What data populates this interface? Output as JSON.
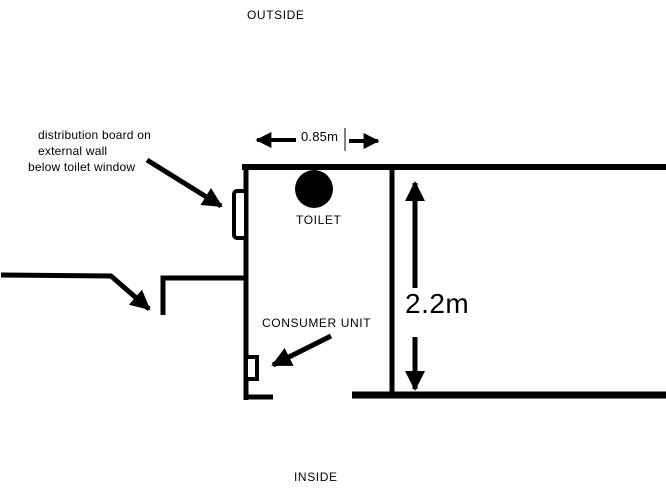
{
  "window": {
    "background": "#ffffff",
    "ink": "#000000"
  },
  "labels": {
    "outside": "OUTSIDE",
    "inside": "INSIDE",
    "toilet": "TOILET",
    "consumer_unit": "CONSUMER UNIT"
  },
  "annotations": {
    "distribution_note_lines": [
      "distribution board on",
      "external wall",
      "below toilet window"
    ]
  },
  "dimensions": {
    "room_width": "0.85m",
    "room_height": "2.2m"
  }
}
